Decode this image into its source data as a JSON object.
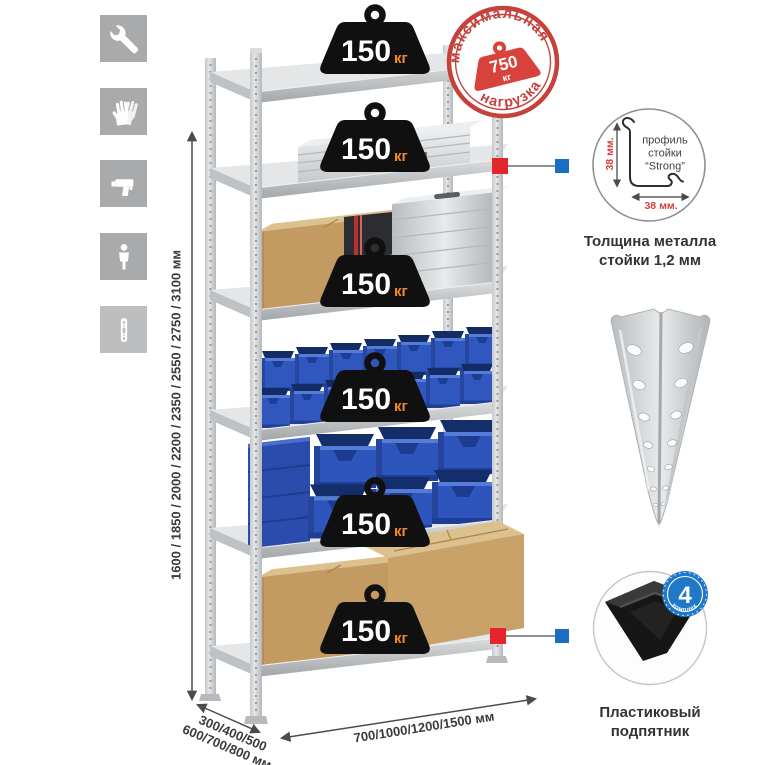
{
  "sidebar": {
    "icons": [
      {
        "name": "wrench"
      },
      {
        "name": "gloves"
      },
      {
        "name": "drill"
      },
      {
        "name": "person-height"
      },
      {
        "name": "perforated-post"
      }
    ]
  },
  "dimensions": {
    "height_label": "1600 / 1850 / 2000 / 2200 / 2350 / 2550 / 2750 / 3100 мм",
    "depth_label_line1": "300/400/500",
    "depth_label_line2": "600/700/800 мм",
    "width_label": "700/1000/1200/1500 мм"
  },
  "stamp": {
    "arc_top": "максимальная",
    "arc_bottom": "нагрузка",
    "weight_value": "750",
    "weight_unit": "кг"
  },
  "shelf_weights": [
    {
      "value": "150",
      "unit": "кг"
    },
    {
      "value": "150",
      "unit": "кг"
    },
    {
      "value": "150",
      "unit": "кг"
    },
    {
      "value": "150",
      "unit": "кг"
    },
    {
      "value": "150",
      "unit": "кг"
    },
    {
      "value": "150",
      "unit": "кг"
    }
  ],
  "profile_detail": {
    "label_line1": "профиль",
    "label_line2": "стойки",
    "label_line3": "“Strong”",
    "dim_vertical": "38 мм.",
    "dim_horizontal": "38 мм.",
    "caption_line1": "Толщина металла",
    "caption_line2": "стойки 1,2 мм"
  },
  "foot_detail": {
    "badge_value": "4",
    "badge_arc": "в комплекте",
    "caption_line1": "Пластиковый",
    "caption_line2": "подпятник"
  },
  "colors": {
    "accent_red": "#c6413c",
    "callout_red": "#e4252b",
    "callout_blue": "#1a6fc4",
    "weight_black": "#101010",
    "kg_orange": "#f18a26",
    "bin_blue": "#2f57bd",
    "cardboard": "#c29a62",
    "metal": "#d6d8da"
  }
}
